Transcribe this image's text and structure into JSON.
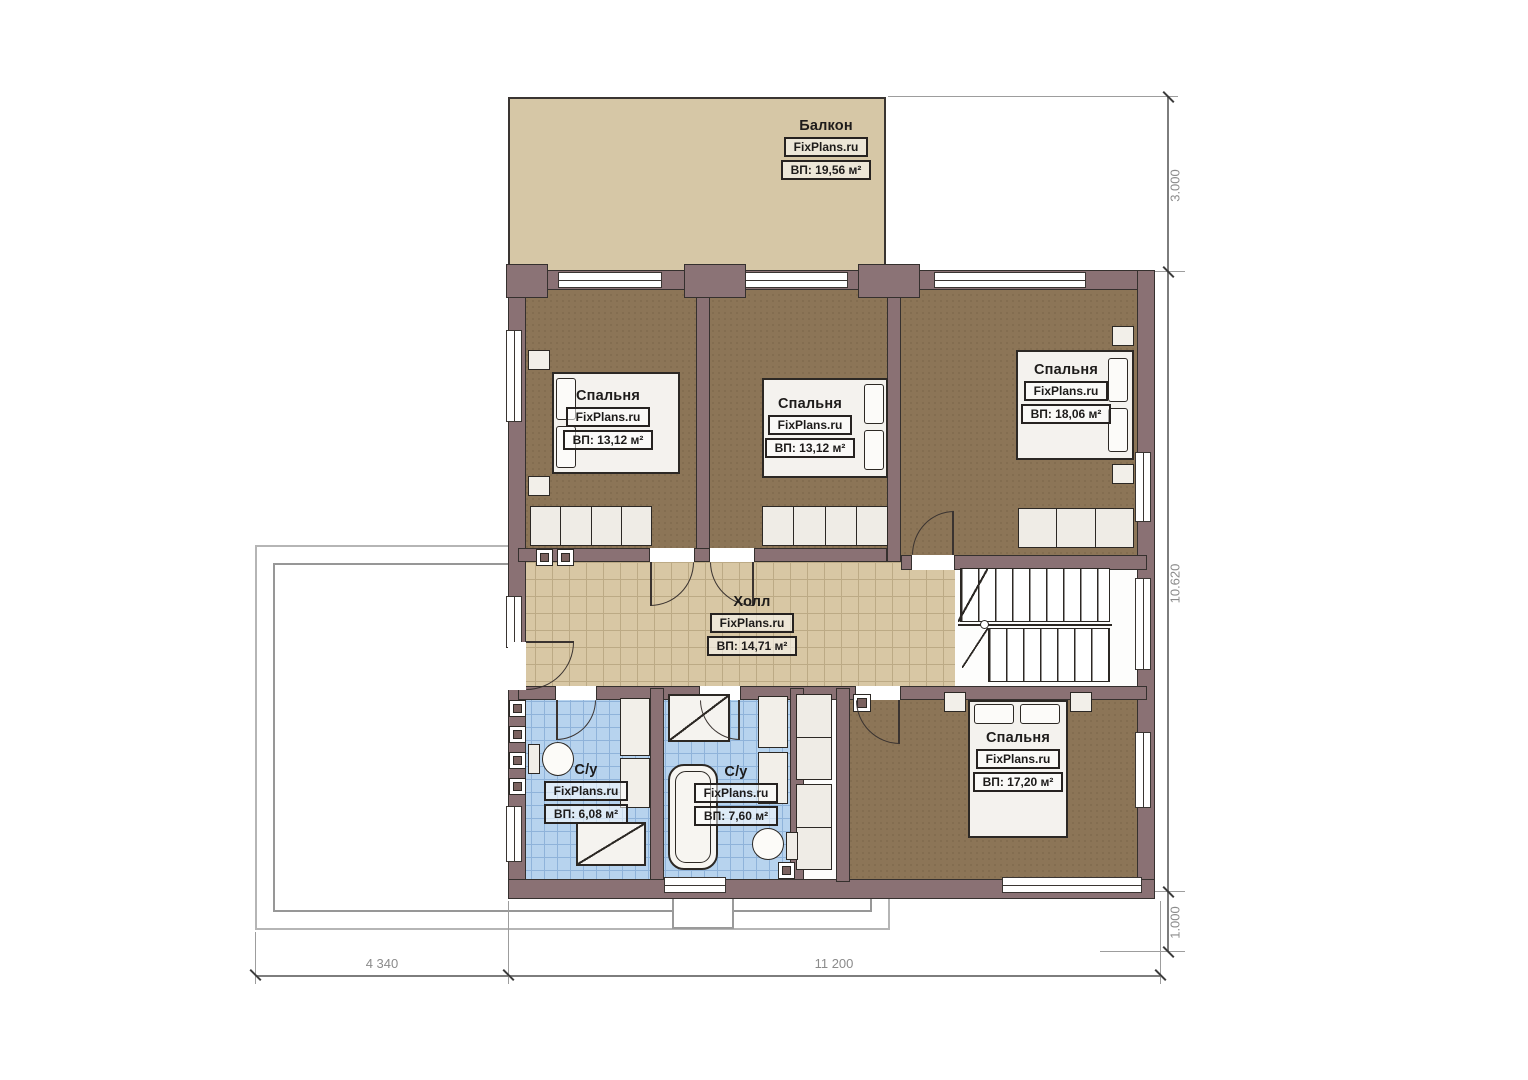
{
  "watermark": "FixPlans.ru",
  "rooms": {
    "balcony": {
      "name": "Балкон",
      "wm": "FixPlans.ru",
      "area": "ВП: 19,56 м²"
    },
    "bedroom1": {
      "name": "Спальня",
      "wm": "FixPlans.ru",
      "area": "ВП: 13,12 м²"
    },
    "bedroom2": {
      "name": "Спальня",
      "wm": "FixPlans.ru",
      "area": "ВП: 13,12 м²"
    },
    "bedroom3": {
      "name": "Спальня",
      "wm": "FixPlans.ru",
      "area": "ВП: 18,06 м²"
    },
    "hall": {
      "name": "Холл",
      "wm": "FixPlans.ru",
      "area": "ВП: 14,71 м²"
    },
    "bath1": {
      "name": "С/у",
      "wm": "FixPlans.ru",
      "area": "ВП: 6,08 м²"
    },
    "bath2": {
      "name": "С/у",
      "wm": "FixPlans.ru",
      "area": "ВП: 7,60 м²"
    },
    "bedroom4": {
      "name": "Спальня",
      "wm": "FixPlans.ru",
      "area": "ВП: 17,20 м²"
    }
  },
  "dimensions": {
    "right_top": "3.000",
    "right_main": "10.620",
    "right_bottom": "1.000",
    "bottom_left": "4 340",
    "bottom_right": "11 200"
  },
  "colors": {
    "wall": "#8a7174",
    "bedroom_floor": "#8c7557",
    "hall_floor": "#d8c7a4",
    "bath_floor": "#b7d3ee",
    "balcony_floor": "#d6c7a6"
  }
}
